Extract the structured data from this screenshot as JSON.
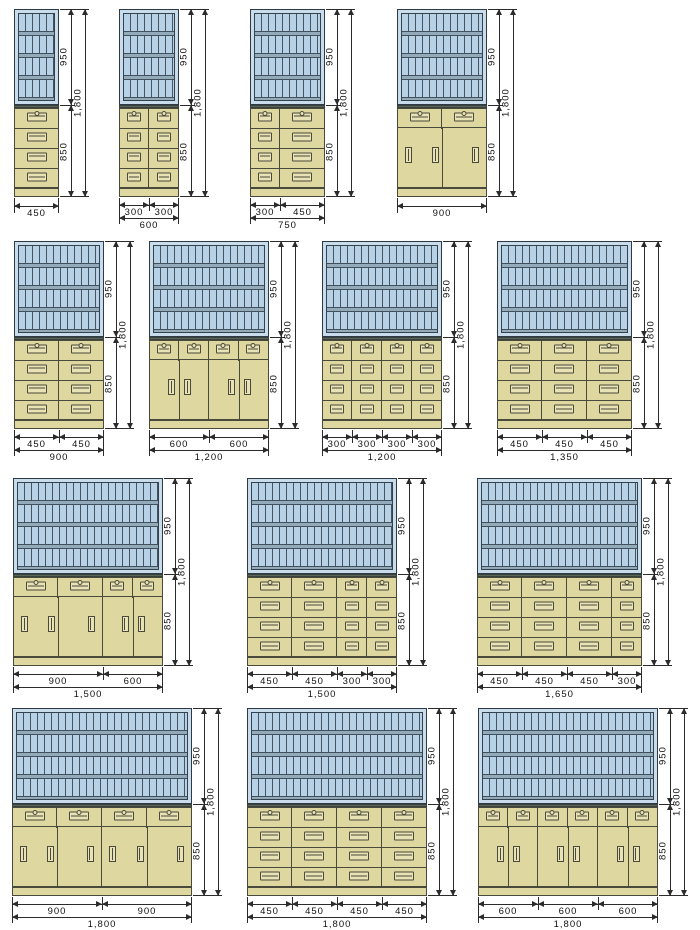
{
  "drawing": {
    "description": "cabinet-elevation-diagram",
    "colors": {
      "glass_fill": "#b7d2e6",
      "glass_frame": "#c9dcec",
      "glass_line": "#47545f",
      "shelf_band": "#93aabb",
      "body_fill": "#ded7a0",
      "body_line": "#4a4a3c",
      "counter": "#5a645c",
      "dim_line": "#2b2b2b",
      "background": "#ffffff"
    },
    "vertical_dims": {
      "upper": "950",
      "lower": "850",
      "total": "1,800"
    },
    "cabinets": [
      {
        "name": "cabinet-450",
        "px": {
          "x": 14,
          "y": 9
        },
        "width_mm": 450,
        "sections": [
          {
            "type": "drawers",
            "w": 450
          }
        ],
        "segment_labels": [],
        "total_label": "450"
      },
      {
        "name": "cabinet-600",
        "px": {
          "x": 119,
          "y": 9
        },
        "width_mm": 600,
        "sections": [
          {
            "type": "drawers",
            "w": 300
          },
          {
            "type": "drawers",
            "w": 300
          }
        ],
        "segment_labels": [
          "300",
          "300"
        ],
        "total_label": "600"
      },
      {
        "name": "cabinet-750",
        "px": {
          "x": 250,
          "y": 9
        },
        "width_mm": 750,
        "sections": [
          {
            "type": "drawers",
            "w": 300
          },
          {
            "type": "drawers",
            "w": 450
          }
        ],
        "segment_labels": [
          "300",
          "450"
        ],
        "total_label": "750"
      },
      {
        "name": "cabinet-900-sliding",
        "px": {
          "x": 397,
          "y": 9
        },
        "width_mm": 900,
        "sections": [
          {
            "type": "sliding",
            "w": 900
          }
        ],
        "segment_labels": [],
        "total_label": "900"
      },
      {
        "name": "cabinet-900",
        "px": {
          "x": 14,
          "y": 241
        },
        "width_mm": 900,
        "sections": [
          {
            "type": "drawers",
            "w": 450
          },
          {
            "type": "drawers",
            "w": 450
          }
        ],
        "segment_labels": [
          "450",
          "450"
        ],
        "total_label": "900"
      },
      {
        "name": "cabinet-1200-doors",
        "px": {
          "x": 149,
          "y": 241
        },
        "width_mm": 1200,
        "sections": [
          {
            "type": "hinged",
            "w": 600
          },
          {
            "type": "hinged",
            "w": 600
          }
        ],
        "segment_labels": [
          "600",
          "600"
        ],
        "total_label": "1,200"
      },
      {
        "name": "cabinet-1200",
        "px": {
          "x": 322,
          "y": 241
        },
        "width_mm": 1200,
        "sections": [
          {
            "type": "drawers",
            "w": 300
          },
          {
            "type": "drawers",
            "w": 300
          },
          {
            "type": "drawers",
            "w": 300
          },
          {
            "type": "drawers",
            "w": 300
          }
        ],
        "segment_labels": [
          "300",
          "300",
          "300",
          "300"
        ],
        "total_label": "1,200"
      },
      {
        "name": "cabinet-1350",
        "px": {
          "x": 497,
          "y": 241
        },
        "width_mm": 1350,
        "sections": [
          {
            "type": "drawers",
            "w": 450
          },
          {
            "type": "drawers",
            "w": 450
          },
          {
            "type": "drawers",
            "w": 450
          }
        ],
        "segment_labels": [
          "450",
          "450",
          "450"
        ],
        "total_label": "1,350"
      },
      {
        "name": "cabinet-1500-mixed",
        "px": {
          "x": 13,
          "y": 478
        },
        "width_mm": 1500,
        "sections": [
          {
            "type": "sliding",
            "w": 900
          },
          {
            "type": "hinged",
            "w": 600
          }
        ],
        "segment_labels": [
          "900",
          "600"
        ],
        "total_label": "1,500"
      },
      {
        "name": "cabinet-1500",
        "px": {
          "x": 247,
          "y": 478
        },
        "width_mm": 1500,
        "sections": [
          {
            "type": "drawers",
            "w": 450
          },
          {
            "type": "drawers",
            "w": 450
          },
          {
            "type": "drawers",
            "w": 300
          },
          {
            "type": "drawers",
            "w": 300
          }
        ],
        "segment_labels": [
          "450",
          "450",
          "300",
          "300"
        ],
        "total_label": "1,500"
      },
      {
        "name": "cabinet-1650",
        "px": {
          "x": 477,
          "y": 478
        },
        "width_mm": 1650,
        "sections": [
          {
            "type": "drawers",
            "w": 450
          },
          {
            "type": "drawers",
            "w": 450
          },
          {
            "type": "drawers",
            "w": 450
          },
          {
            "type": "drawers",
            "w": 300
          }
        ],
        "segment_labels": [
          "450",
          "450",
          "450",
          "300"
        ],
        "total_label": "1,650"
      },
      {
        "name": "cabinet-1800-sliding",
        "px": {
          "x": 12,
          "y": 708
        },
        "width_mm": 1800,
        "sections": [
          {
            "type": "sliding",
            "w": 900
          },
          {
            "type": "sliding",
            "w": 900
          }
        ],
        "segment_labels": [
          "900",
          "900"
        ],
        "total_label": "1,800"
      },
      {
        "name": "cabinet-1800",
        "px": {
          "x": 247,
          "y": 708
        },
        "width_mm": 1800,
        "sections": [
          {
            "type": "drawers",
            "w": 450
          },
          {
            "type": "drawers",
            "w": 450
          },
          {
            "type": "drawers",
            "w": 450
          },
          {
            "type": "drawers",
            "w": 450
          }
        ],
        "segment_labels": [
          "450",
          "450",
          "450",
          "450"
        ],
        "total_label": "1,800"
      },
      {
        "name": "cabinet-1800-doors",
        "px": {
          "x": 478,
          "y": 708
        },
        "width_mm": 1800,
        "sections": [
          {
            "type": "hinged",
            "w": 600
          },
          {
            "type": "hinged",
            "w": 600
          },
          {
            "type": "hinged",
            "w": 600
          }
        ],
        "segment_labels": [
          "600",
          "600",
          "600"
        ],
        "total_label": "1,800"
      }
    ]
  }
}
